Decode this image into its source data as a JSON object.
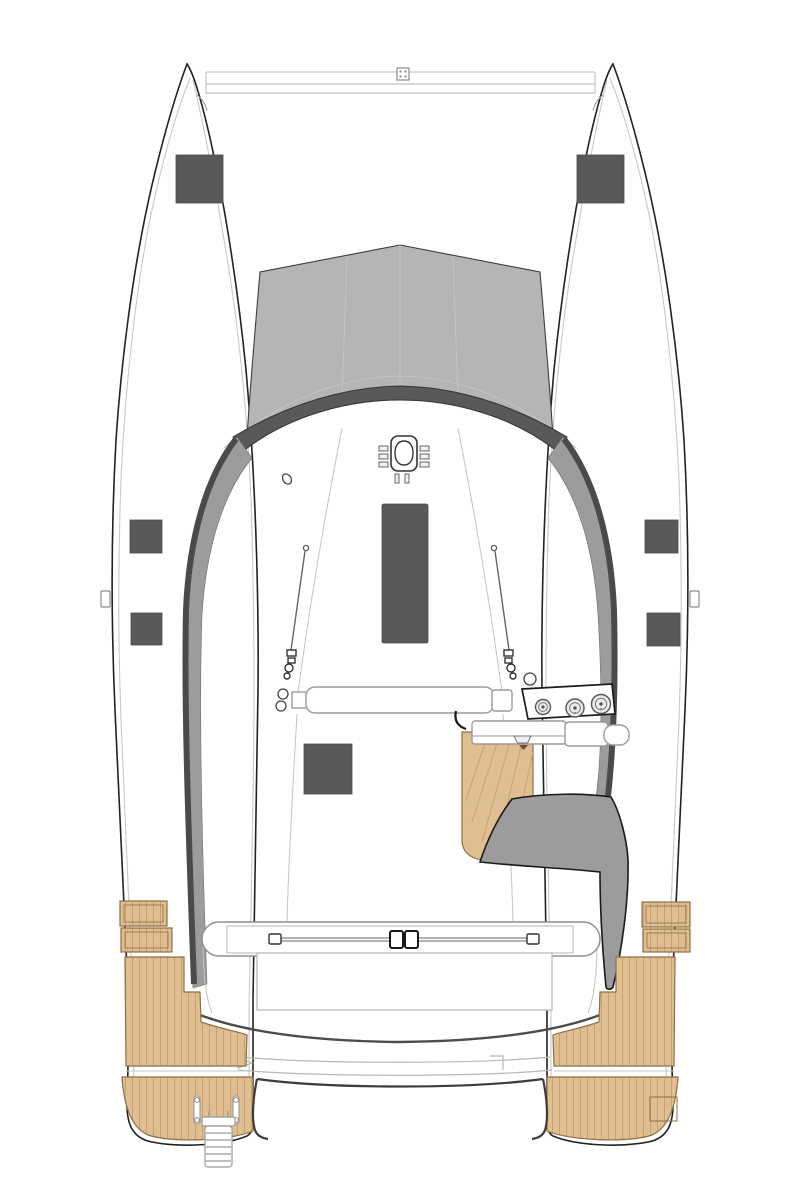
{
  "diagram": {
    "type": "catamaran-deck-plan-top-view",
    "subject": "sailing-catamaran",
    "view": "overhead",
    "colors": {
      "hull_outline": "#222222",
      "hull_inner_line": "#c9c9c9",
      "foredeck_gray": "#b5b5b5",
      "dark_gray": "#595959",
      "band_gray": "#9c9c9c",
      "band_dark": "#4a4a4a",
      "seam_gray": "#c4c4c4",
      "teak": "#dfbe92",
      "teak_stroke": "#8f6f43",
      "teak_plank": "#c7a171",
      "fitting_gray": "#8c8c8c",
      "white": "#ffffff"
    },
    "components": [
      "port-hull",
      "starboard-hull",
      "forward-crossbeam",
      "crossbeam-center-fitting",
      "foredeck-panels",
      "coachroof-front-arc",
      "port-coachroof-band",
      "starboard-coachroof-band",
      "mast-step",
      "halyard-clutches",
      "deck-padeye",
      "cabin-skylight-hatch",
      "cabin-aft-hatch",
      "port-deck-hatches",
      "starboard-deck-hatches",
      "port-shroud",
      "starboard-shroud",
      "boom",
      "gooseneck-rings",
      "helm-station-panel",
      "winches",
      "helm-seat-bars",
      "cleat",
      "helm-teak-floor",
      "helm-bench",
      "mainsheet-traveler",
      "traveler-car",
      "traveler-end-stops",
      "cockpit-bench",
      "cockpit-aft-sweep",
      "aft-step",
      "transom-sweep",
      "port-teak-steps",
      "starboard-teak-steps",
      "port-teak-side-deck",
      "starboard-teak-side-deck",
      "port-swim-platform",
      "starboard-swim-platform",
      "grab-handles",
      "transom-ladder",
      "port-gate-notch",
      "starboard-gate-notch"
    ],
    "counts": {
      "winches": 3,
      "dark_hatches": 8,
      "grab_handles": 2,
      "ladder_rungs": 5
    }
  }
}
